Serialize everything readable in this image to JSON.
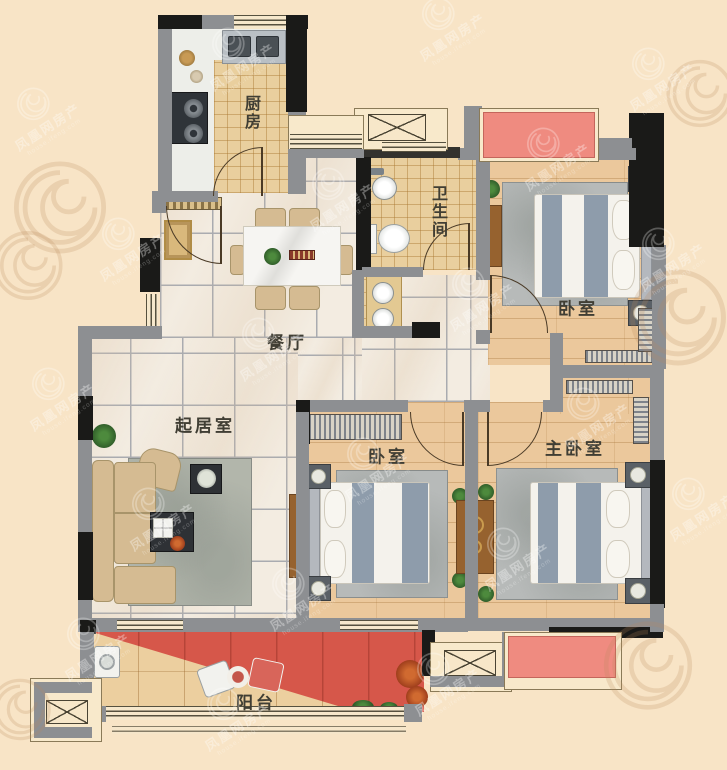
{
  "rooms": {
    "kitchen": {
      "label": "厨房"
    },
    "bathroom": {
      "label": "卫生间"
    },
    "bedroom_north": {
      "label": "卧室"
    },
    "dining": {
      "label": "餐厅"
    },
    "living": {
      "label": "起居室"
    },
    "bedroom_middle": {
      "label": "卧室"
    },
    "master": {
      "label": "主卧室"
    },
    "balcony": {
      "label": "阳台"
    }
  },
  "watermark": {
    "brand": "凤凰网房产",
    "domain": "house.ifeng.com"
  },
  "colors": {
    "background": "#f8e4c6",
    "wall_gray": "#8d8f92",
    "wall_black": "#1a1a18",
    "marble_floor": "#f3ece1",
    "wood_floor": "#ebc89c",
    "tile_tan": "#e9cf9e",
    "accent_red": "#d6574a",
    "flowerbed_red": "#ef8b80",
    "label_text": "#403e34"
  }
}
